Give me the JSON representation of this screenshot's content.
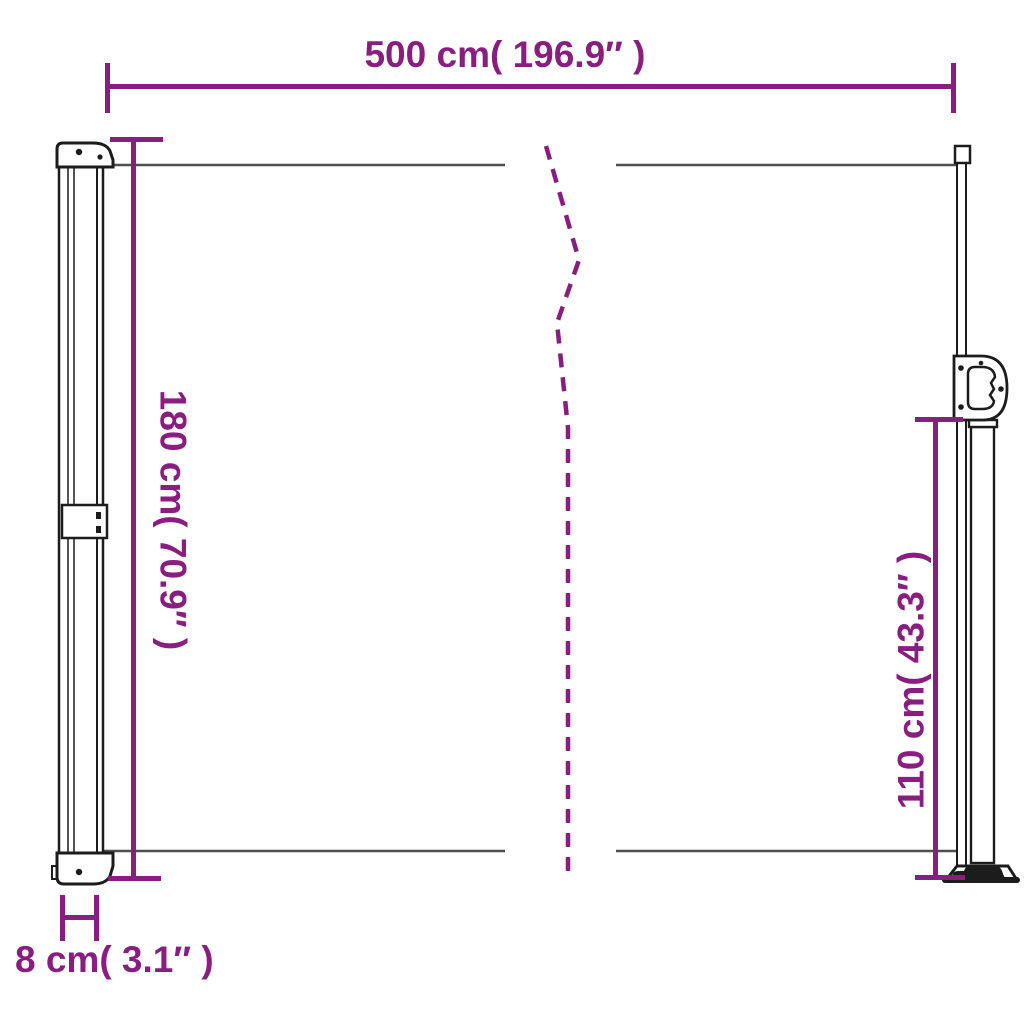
{
  "diagram": {
    "type": "product-dimension-drawing",
    "subject": "retractable-side-awning",
    "dimensions": {
      "width": {
        "label": "500 cm( 196.9″ )"
      },
      "height_total": {
        "label": "180 cm( 70.9″ )"
      },
      "height_pole": {
        "label": "110 cm( 43.3″ )"
      },
      "depth": {
        "label": "8 cm( 3.1″ )"
      }
    },
    "colors": {
      "dimension": "#8A1D80",
      "outline": "#1c1c1c",
      "fabric_edge": "#4f4f4f",
      "background": "#ffffff"
    }
  }
}
